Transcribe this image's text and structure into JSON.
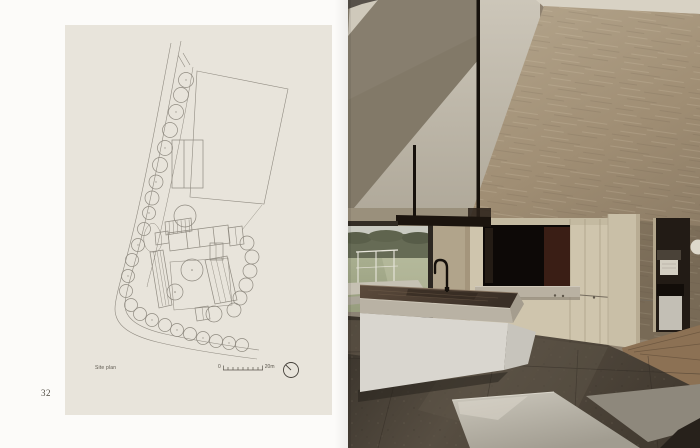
{
  "book_spread": {
    "left_page": {
      "page_number": "32",
      "figure": {
        "caption": "Site plan",
        "scale_bar": {
          "start_label": "0",
          "end_label": "20m"
        }
      }
    },
    "right_page": {
      "photo": {
        "kind": "photograph"
      }
    }
  },
  "icons": {
    "north_indicator": "north-arrow-icon"
  },
  "colors": {
    "page_background": "#fbfaf7",
    "plan_panel_background": "#e8e4db",
    "plan_line": "#8f8a80",
    "caption_text": "#5b564d",
    "ceiling_shadow_plane": "#877e6e",
    "gable_wall": "#c6c0b2",
    "plaster_wall": "#a3917a",
    "cabinet_wood": "#cfc5ad",
    "island_base": "#d9d6cf",
    "island_top": "#4a3d31",
    "stone_floor": "#453d33",
    "black_steel": "#16110c"
  }
}
